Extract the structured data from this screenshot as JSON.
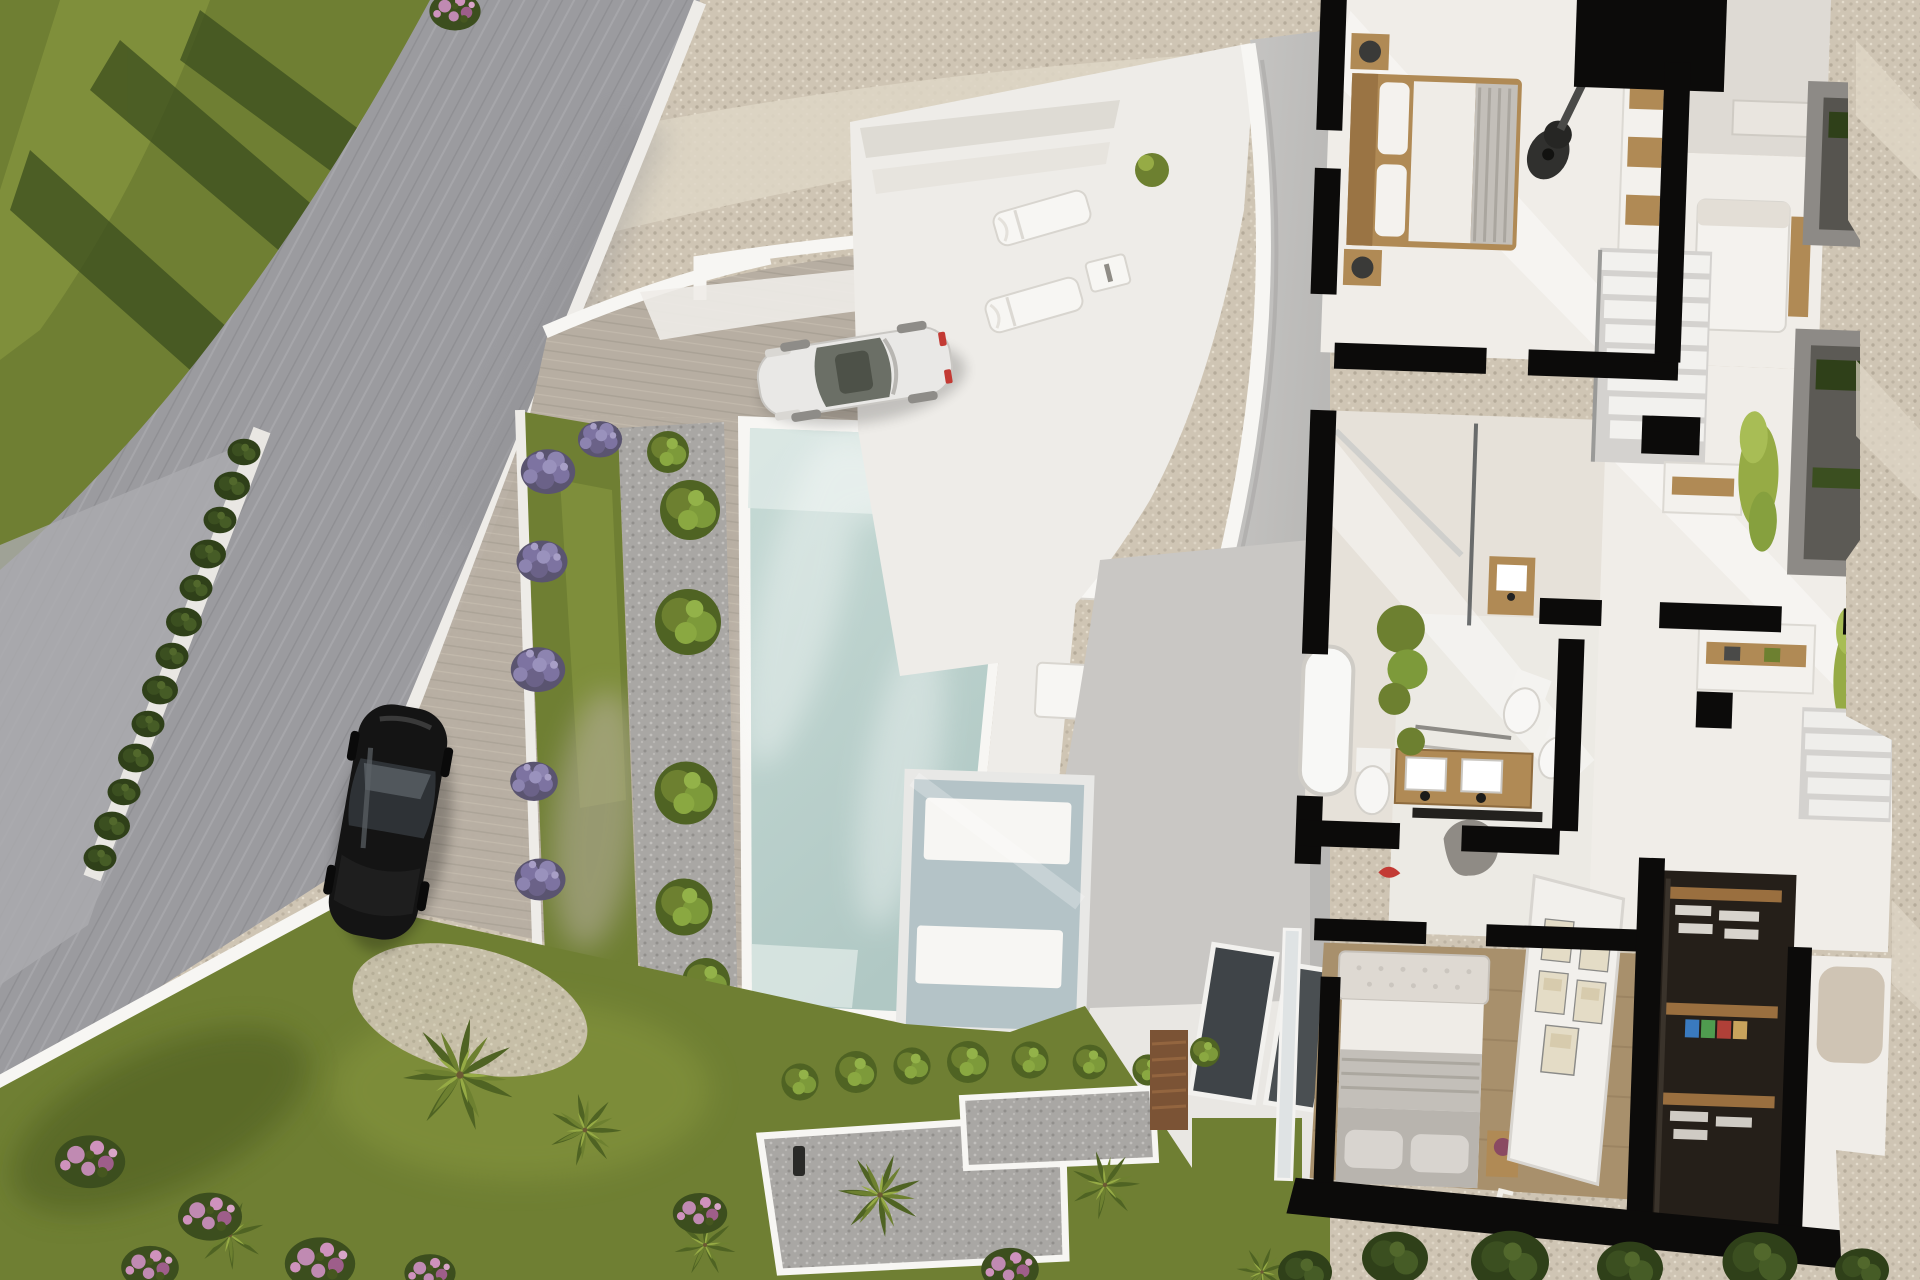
{
  "meta": {
    "title": "Top-down aerial 3D render — modern villa with infinity pool, garden and cutaway interior floor plan",
    "view": "bird's-eye / plan cutaway",
    "render_type": "architectural visualization"
  },
  "palette": {
    "road": "#9b9b9f",
    "road_light": "#ababaf",
    "grass": "#6f7f33",
    "grass_light": "#8a9a41",
    "grass_shadow": "#46571f",
    "tree_shadow": "#3c4e1e",
    "gravel": "#cfc5b4",
    "gravel_light": "#ded6c6",
    "pebble": "#a9a7a4",
    "pavement": "#b7aea2",
    "pavement_dark": "#a59c90",
    "white_surface": "#eeece8",
    "white_bright": "#f7f6f3",
    "pool_water": "#c6dad5",
    "pool_water_deep": "#b0c8c4",
    "pool_steps": "#dde9e5",
    "skylight_glass": "#b4c3c7",
    "hedge": "#42551f",
    "palm_dark": "#4f6323",
    "palm_mid": "#6d8030",
    "palm_light": "#96ab45",
    "lavender": "#7d73a1",
    "lavender_dark": "#5a5470",
    "flower_pink": "#c08ab2",
    "flower_pink_dark": "#9e5e8a",
    "wall_black": "#0c0b0a",
    "floor_white": "#f0ede8",
    "floor_warm": "#e6e1d9",
    "floor_wood": "#a8906c",
    "wood": "#b08a55",
    "wood_dark": "#7b5335",
    "closet_dark": "#251f19",
    "balcony_gray": "#8d8a86",
    "curve_gray": "#c6c5c3",
    "terrace_gray": "#c9c7c4",
    "car_white": "#e9e8e6",
    "car_black": "#141414",
    "glass_dark": "#3f4448",
    "bed_gray": "#c3bfb9",
    "art_beige": "#e4dcc6"
  },
  "scene": {
    "objects": [
      {
        "name": "public-road",
        "desc": "curved gray asphalt road running diagonally down the left side"
      },
      {
        "name": "lower-road",
        "desc": "second road level at far lower-left behind retaining wall"
      },
      {
        "name": "hedge-row",
        "desc": "clipped green hedge along road retaining wall"
      },
      {
        "name": "lavender-row",
        "desc": "row of purple lavender shrubs on upper gravel bank"
      },
      {
        "name": "retaining-steps",
        "desc": "white stepped retaining walls between gravel bank and parking"
      },
      {
        "name": "driveway",
        "desc": "stone-paved parking forecourt"
      },
      {
        "name": "white-car",
        "desc": "white coupe parked on forecourt, red tail-light accents"
      },
      {
        "name": "black-car",
        "desc": "black sedan parked on road lay-by"
      },
      {
        "name": "lawn-strip",
        "desc": "narrow lawn terrace with purple flower bushes"
      },
      {
        "name": "gravel-planting-strip",
        "desc": "pebble strip with round green shrubs beside pool"
      },
      {
        "name": "swimming-pool",
        "desc": "long rectangular pool with entry steps at both ends"
      },
      {
        "name": "pool-deck",
        "desc": "white deck with step platforms and benches"
      },
      {
        "name": "roof-terrace",
        "desc": "white roof terrace with two sun loungers and side table"
      },
      {
        "name": "curved-parapet",
        "desc": "sweeping curved white parapet wall of the villa"
      },
      {
        "name": "lower-terrace",
        "desc": "gray lower-level terrace behind the curve"
      },
      {
        "name": "skylight",
        "desc": "glass skylight showing white daybeds on the level below"
      },
      {
        "name": "garden",
        "desc": "lawn garden with palms, pink flowering shrubs, gravel beds and planters"
      },
      {
        "name": "timber-fence",
        "desc": "small wooden slat screen by the planters"
      },
      {
        "name": "villa-floor-plan",
        "desc": "cutaway interior: bedrooms, bathrooms, hallway, stairs, wardrobe"
      },
      {
        "name": "gravel-terrain",
        "desc": "rocky gravel hillside along the right edge"
      }
    ],
    "floor_plan_rooms": [
      {
        "name": "bedroom-1",
        "desc": "double bed with timber frame, nightstands, lamps, guitar, fitted wardrobe"
      },
      {
        "name": "shower-room",
        "desc": "small shower room, wall shower head"
      },
      {
        "name": "bedroom-3",
        "desc": "partially visible bedroom with white bed"
      },
      {
        "name": "bathroom",
        "desc": "bathtub, tall plant, WC, timber vanity, shower screen, towel rails"
      },
      {
        "name": "master-bathroom",
        "desc": "double timber vanity with two basins, WC and bidet, gray lounge chair"
      },
      {
        "name": "hallway",
        "desc": "hall with white sideboards, timber niches and climbing plants"
      },
      {
        "name": "staircase",
        "desc": "white stair flight with glass balustrade"
      },
      {
        "name": "balconies",
        "desc": "gray framed balconies with hedge planters"
      },
      {
        "name": "bedroom-2",
        "desc": "bed with tufted headboard on timber floor, gallery picture wall, letter decor"
      },
      {
        "name": "walk-in-wardrobe",
        "desc": "dark walk-in closet with timber shelves, folded clothes, colored boxes"
      }
    ],
    "counts": {
      "sun_loungers": 2,
      "cars": 2,
      "palms": 7,
      "lavender_bushes": 8
    }
  },
  "decor": {
    "letter": "E"
  },
  "instances": {
    "lavender": {
      "symbol": "#sym-lavender",
      "name": "lavender-bush",
      "items": [
        {
          "x": 420,
          "y": 105,
          "s": 1.0
        },
        {
          "x": 518,
          "y": 85,
          "s": 1.1
        },
        {
          "x": 665,
          "y": 95,
          "s": 0.9
        },
        {
          "x": 832,
          "y": 86,
          "s": 1.3
        },
        {
          "x": 940,
          "y": 72,
          "s": 1.1
        },
        {
          "x": 1064,
          "y": 55,
          "s": 1.15
        },
        {
          "x": 1126,
          "y": 48,
          "s": 0.95
        },
        {
          "x": 1212,
          "y": 38,
          "s": 1.1
        }
      ]
    },
    "green_bushes": {
      "symbol": "#sym-bushgreen",
      "name": "round-shrub",
      "items": [
        {
          "x": 690,
          "y": 510,
          "s": 1.0
        },
        {
          "x": 688,
          "y": 622,
          "s": 1.1
        },
        {
          "x": 686,
          "y": 793,
          "s": 1.05
        },
        {
          "x": 684,
          "y": 907,
          "s": 0.95
        },
        {
          "x": 706,
          "y": 982,
          "s": 0.8
        },
        {
          "x": 668,
          "y": 452,
          "s": 0.7
        }
      ]
    },
    "purple_bushes": {
      "symbol": "#sym-lavender",
      "name": "flower-bush-purple",
      "items": [
        {
          "x": 548,
          "y": 470,
          "s": 0.8
        },
        {
          "x": 542,
          "y": 560,
          "s": 0.75
        },
        {
          "x": 538,
          "y": 668,
          "s": 0.8
        },
        {
          "x": 534,
          "y": 780,
          "s": 0.7
        },
        {
          "x": 540,
          "y": 878,
          "s": 0.75
        },
        {
          "x": 600,
          "y": 438,
          "s": 0.65
        }
      ]
    },
    "palms": {
      "symbol": "#sym-palm",
      "name": "palm-tree",
      "items": [
        {
          "x": 460,
          "y": 1075,
          "s": 1.55,
          "r": 10
        },
        {
          "x": 230,
          "y": 1235,
          "s": 0.95,
          "r": -30
        },
        {
          "x": 585,
          "y": 1130,
          "s": 1.0,
          "r": 40
        },
        {
          "x": 705,
          "y": 1245,
          "s": 0.85,
          "r": 0
        },
        {
          "x": 880,
          "y": 1195,
          "s": 1.15,
          "r": 70
        },
        {
          "x": 1105,
          "y": 1185,
          "s": 0.95,
          "r": -15
        },
        {
          "x": 1262,
          "y": 1272,
          "s": 0.7,
          "r": 20
        }
      ]
    },
    "pink_flowers": {
      "symbol": "#sym-flowerpink",
      "name": "flowering-shrub-pink",
      "items": [
        {
          "x": 90,
          "y": 1160,
          "s": 1.1
        },
        {
          "x": 210,
          "y": 1215,
          "s": 1.0
        },
        {
          "x": 320,
          "y": 1262,
          "s": 1.1
        },
        {
          "x": 150,
          "y": 1266,
          "s": 0.9
        },
        {
          "x": 430,
          "y": 1272,
          "s": 0.8
        },
        {
          "x": 700,
          "y": 1212,
          "s": 0.85
        },
        {
          "x": 1010,
          "y": 1268,
          "s": 0.9
        },
        {
          "x": 455,
          "y": 10,
          "s": 0.8
        }
      ]
    },
    "loungers": {
      "symbol": "#sym-lounger",
      "name": "sun-lounger",
      "items": [
        {
          "x": 1042,
          "y": 218,
          "r": -16,
          "s": 1
        },
        {
          "x": 1034,
          "y": 305,
          "r": -16,
          "s": 1
        }
      ]
    },
    "planter_shrubs": {
      "symbol": "#sym-bushgreen",
      "name": "planter-shrub",
      "items": [
        {
          "x": 800,
          "y": 1082,
          "s": 0.62
        },
        {
          "x": 856,
          "y": 1072,
          "s": 0.7
        },
        {
          "x": 912,
          "y": 1066,
          "s": 0.62
        },
        {
          "x": 968,
          "y": 1062,
          "s": 0.7
        },
        {
          "x": 1030,
          "y": 1060,
          "s": 0.62
        },
        {
          "x": 1090,
          "y": 1062,
          "s": 0.58
        },
        {
          "x": 1148,
          "y": 1070,
          "s": 0.52
        },
        {
          "x": 1205,
          "y": 1052,
          "s": 0.5
        }
      ]
    },
    "dark_bushes": {
      "symbol": "#sym-bushdark",
      "name": "hedge-bush",
      "items": [
        {
          "x": 1395,
          "y": 1258,
          "s": 1.1
        },
        {
          "x": 1510,
          "y": 1262,
          "s": 1.3
        },
        {
          "x": 1630,
          "y": 1268,
          "s": 1.1
        },
        {
          "x": 1760,
          "y": 1262,
          "s": 1.25
        },
        {
          "x": 1862,
          "y": 1270,
          "s": 0.9
        },
        {
          "x": 1305,
          "y": 1272,
          "s": 0.9
        }
      ]
    },
    "frames": {
      "symbol": "#sym-frame",
      "name": "picture-frame",
      "items": [
        {
          "x": 1556,
          "y": 920,
          "r": 4,
          "s": 1
        },
        {
          "x": 1594,
          "y": 928,
          "r": 4,
          "s": 1
        },
        {
          "x": 1552,
          "y": 972,
          "r": 4,
          "s": 1
        },
        {
          "x": 1590,
          "y": 980,
          "r": 4,
          "s": 1
        },
        {
          "x": 1560,
          "y": 1026,
          "r": 4,
          "s": 1.15
        }
      ]
    },
    "hedge_bumps": {
      "symbol": "#sym-bushdark",
      "name": "hedge-clipped",
      "items": [
        {
          "x": 244,
          "y": 452,
          "s": 0.55
        },
        {
          "x": 232,
          "y": 486,
          "s": 0.6
        },
        {
          "x": 220,
          "y": 520,
          "s": 0.55
        },
        {
          "x": 208,
          "y": 554,
          "s": 0.6
        },
        {
          "x": 196,
          "y": 588,
          "s": 0.55
        },
        {
          "x": 184,
          "y": 622,
          "s": 0.6
        },
        {
          "x": 172,
          "y": 656,
          "s": 0.55
        },
        {
          "x": 160,
          "y": 690,
          "s": 0.6
        },
        {
          "x": 148,
          "y": 724,
          "s": 0.55
        },
        {
          "x": 136,
          "y": 758,
          "s": 0.6
        },
        {
          "x": 124,
          "y": 792,
          "s": 0.55
        },
        {
          "x": 112,
          "y": 826,
          "s": 0.6
        },
        {
          "x": 100,
          "y": 858,
          "s": 0.55
        }
      ]
    }
  }
}
